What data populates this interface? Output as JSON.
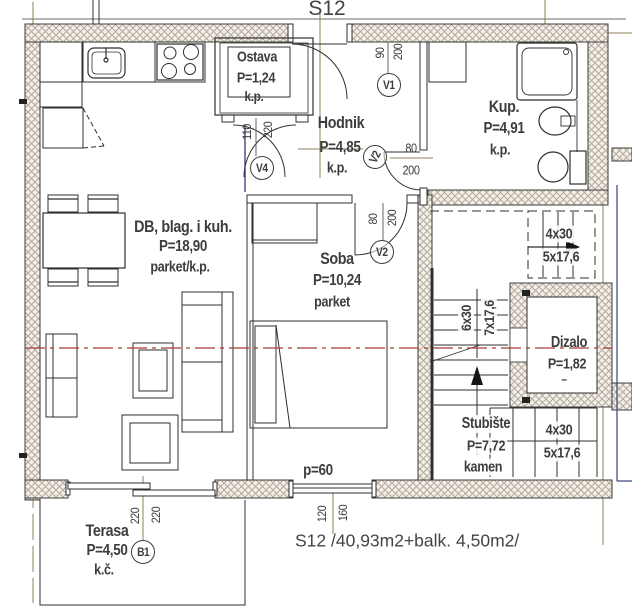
{
  "title": "S12",
  "caption": "S12 /40,93m2+balk. 4,50m2/",
  "rooms": {
    "ostava": {
      "name": "Ostava",
      "area": "P=1,24",
      "floor": "k.p."
    },
    "hodnik": {
      "name": "Hodnik",
      "area": "P=4,85",
      "floor": "k.p."
    },
    "kupaonica": {
      "name": "Kup.",
      "area": "P=4,91",
      "floor": "k.p."
    },
    "dnevni": {
      "name": "DB, blag. i kuh.",
      "area": "P=18,90",
      "floor": "parket/k.p."
    },
    "soba": {
      "name": "Soba",
      "area": "P=10,24",
      "floor": "parket"
    },
    "dizalo": {
      "name": "Dizalo",
      "area": "P=1,82",
      "floor": "–"
    },
    "stubiste": {
      "name": "Stubište",
      "area": "P=7,72",
      "floor": "kamen"
    },
    "terasa": {
      "name": "Terasa",
      "area": "P=4,50",
      "floor": "k.č."
    }
  },
  "doors": {
    "v1": {
      "label": "V1",
      "w": "90",
      "h": "200"
    },
    "v2_kup": {
      "label": "V2",
      "w": "80",
      "h": "200"
    },
    "v2_soba": {
      "label": "V2",
      "w": "80",
      "h": "200"
    },
    "v4": {
      "label": "V4",
      "w": "110",
      "h": "220"
    },
    "b1": {
      "label": "B1",
      "w": "220",
      "h": "220"
    }
  },
  "window": {
    "label": "p=60",
    "w": "120",
    "h": "160"
  },
  "stairs": {
    "upper": {
      "run": "4x30",
      "rise": "5x17,6"
    },
    "middle": {
      "run": "6x30",
      "rise": "7x17,6"
    },
    "lower": {
      "run": "4x30",
      "rise": "5x17,6"
    }
  },
  "colors": {
    "wall_hatch": "#b3a898",
    "axis_red": "#a93c34",
    "centerline_olive": "#8f8258",
    "section_blue": "#33427a",
    "ink": "#2f2f2f"
  }
}
